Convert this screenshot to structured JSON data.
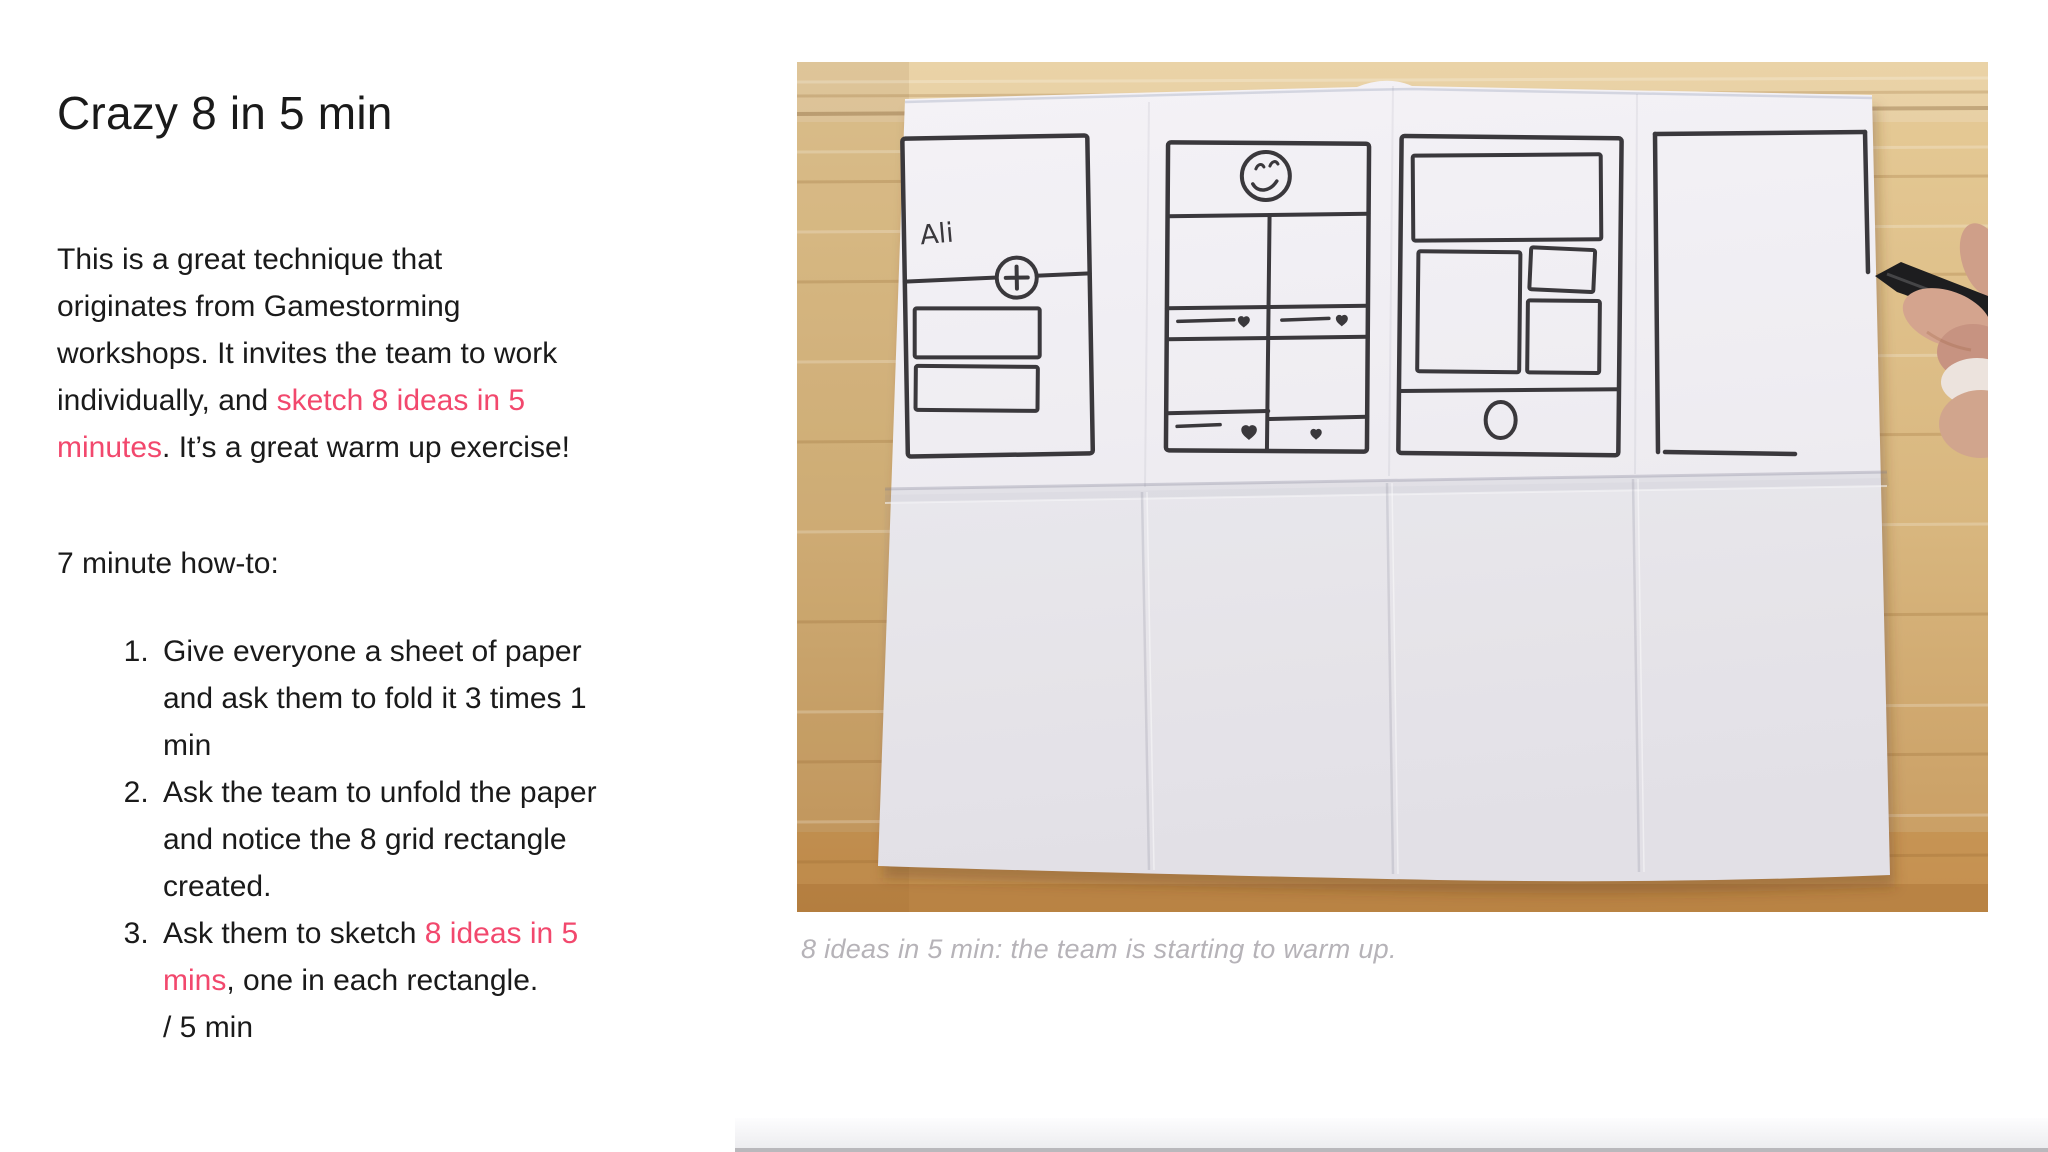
{
  "theme": {
    "accent_color": "#f2486d",
    "text_color": "#1a1a1a",
    "caption_color": "#b6b3b8",
    "sketch_ink_color": "#3a383c"
  },
  "slide": {
    "title": "Crazy 8 in 5 min",
    "intro_segments": [
      {
        "t": "This is a great technique that"
      },
      {
        "t": "originates from Gamestorming",
        "br": true
      },
      {
        "t": "workshops. It invites the team to work",
        "br": true
      },
      {
        "t": "individually, and ",
        "br": true
      },
      {
        "t": "sketch 8 ideas in 5",
        "c": "accent"
      },
      {
        "t": "minutes",
        "c": "accent",
        "br": true
      },
      {
        "t": ". It’s a great warm up exercise!"
      }
    ],
    "howto_heading": "7 minute how-to:",
    "steps": [
      {
        "segments": [
          {
            "t": "Give everyone a sheet of paper"
          },
          {
            "t": "and ask them to fold it 3 times 1",
            "br": true
          },
          {
            "t": "min",
            "br": true
          }
        ]
      },
      {
        "segments": [
          {
            "t": "Ask the team to unfold the paper"
          },
          {
            "t": "and notice the 8 grid rectangle",
            "br": true
          },
          {
            "t": "created.",
            "br": true
          }
        ]
      },
      {
        "segments": [
          {
            "t": "Ask them to sketch "
          },
          {
            "t": "8 ideas in 5",
            "c": "accent"
          },
          {
            "t": "mins",
            "c": "accent",
            "br": true
          },
          {
            "t": ", one in each rectangle."
          },
          {
            "t": "/ 5 min",
            "br": true
          }
        ]
      }
    ]
  },
  "figure": {
    "caption": "8 ideas in 5 min: the team is starting to warm up.",
    "sketch_label": "Ali"
  }
}
